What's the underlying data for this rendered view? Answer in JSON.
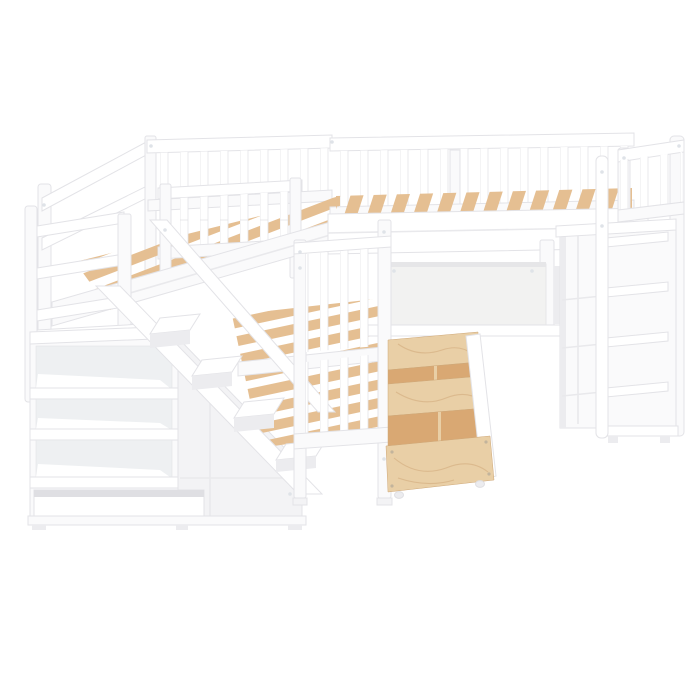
{
  "image": {
    "kind": "product-photo",
    "description": "White wooden L-shaped twin-size bunk bed set photographed on a plain white background: two upper loft beds joined at a corner with slatted decks and spindle guard railings, a storage staircase with open shelf cubbies on the left, a lower twin bed with spindle footboard in the middle, two open natural-plywood under-bed storage drawers with dividers at the bottom center, a desk privacy panel under the right loft bed, and a shelf cabinet with an attached vertical ladder on the right end.",
    "background": "#ffffff"
  },
  "palette": {
    "bg": "#ffffff",
    "white_base": "#fafafb",
    "white_bright": "#ffffff",
    "white_soft": "#f3f3f5",
    "white_shade": "#ececef",
    "outline": "#e3e3e7",
    "seam": "#e9e9ec",
    "interior": "#eef0f2",
    "slot": "#dfdfe3",
    "wood": "#e5bf92",
    "wood_deep": "#d9a873",
    "ply": "#e9cfa6",
    "ply_grain": "#cfa878",
    "desk_panel": "#f2f2f1",
    "desk_edge": "#e6e6e8",
    "bolt": "#dfe3e8",
    "screw": "#c3b49c"
  },
  "parts": [
    "upper-left loft bed",
    "upper-right loft bed",
    "right headboard",
    "landing guard railing",
    "storage staircase with three cubbies",
    "stair handrail and stringer",
    "lower twin bed footboard",
    "two plywood storage drawers",
    "desk privacy panel",
    "shelf column",
    "side cabinet",
    "vertical ladder"
  ]
}
